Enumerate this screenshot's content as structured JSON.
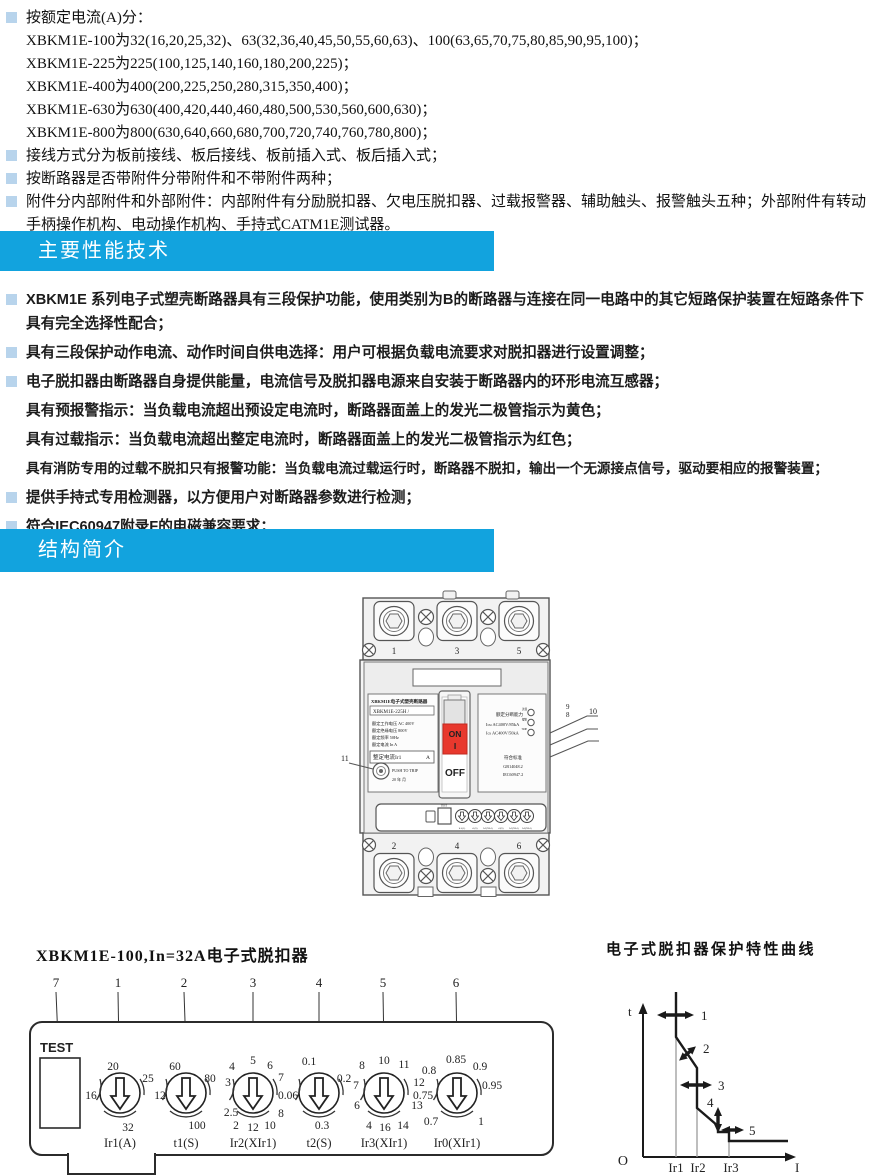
{
  "colors": {
    "accent_blue": "#12A3DE",
    "bullet_blue": "#B8D4EC",
    "on_red": "#E8382D"
  },
  "headers": {
    "performance": "主要性能技术",
    "structure": "结构简介"
  },
  "section1": {
    "items": [
      {
        "bullet": true,
        "text": "按额定电流(A)分："
      },
      {
        "bullet": false,
        "text": "XBKM1E-100为32(16,20,25,32)、63(32,36,40,45,50,55,60,63)、100(63,65,70,75,80,85,90,95,100)；"
      },
      {
        "bullet": false,
        "text": "XBKM1E-225为225(100,125,140,160,180,200,225)；"
      },
      {
        "bullet": false,
        "text": "XBKM1E-400为400(200,225,250,280,315,350,400)；"
      },
      {
        "bullet": false,
        "text": "XBKM1E-630为630(400,420,440,460,480,500,530,560,600,630)；"
      },
      {
        "bullet": false,
        "text": "XBKM1E-800为800(630,640,660,680,700,720,740,760,780,800)；"
      },
      {
        "bullet": true,
        "text": "接线方式分为板前接线、板后接线、板前插入式、板后插入式；"
      },
      {
        "bullet": true,
        "text": "按断路器是否带附件分带附件和不带附件两种；"
      },
      {
        "bullet": true,
        "text": "附件分内部附件和外部附件：内部附件有分励脱扣器、欠电压脱扣器、过载报警器、辅助触头、报警触头五种；外部附件有转动手柄操作机构、电动操作机构、手持式CATM1E测试器。"
      }
    ]
  },
  "section2": {
    "items": [
      {
        "bullet": true,
        "text": "XBKM1E 系列电子式塑壳断路器具有三段保护功能，使用类别为B的断路器与连接在同一电路中的其它短路保护装置在短路条件下具有完全选择性配合；"
      },
      {
        "bullet": true,
        "text": "具有三段保护动作电流、动作时间自供电选择：用户可根据负载电流要求对脱扣器进行设置调整；"
      },
      {
        "bullet": true,
        "text": "电子脱扣器由断路器自身提供能量，电流信号及脱扣器电源来自安装于断路器内的环形电流互感器；"
      },
      {
        "bullet": false,
        "text": "具有预报警指示：当负载电流超出预设定电流时，断路器面盖上的发光二极管指示为黄色；"
      },
      {
        "bullet": false,
        "text": "具有过载指示：当负载电流超出整定电流时，断路器面盖上的发光二极管指示为红色；"
      },
      {
        "bullet": false,
        "text": "具有消防专用的过载不脱扣只有报警功能：当负载电流过载运行时，断路器不脱扣，输出一个无源接点信号，驱动要相应的报警装置；"
      },
      {
        "bullet": true,
        "text": "提供手持式专用检测器，以方便用户对断路器参数进行检测；"
      },
      {
        "bullet": true,
        "text": "符合IEC60947附录F的电磁兼容要求；"
      }
    ]
  },
  "breaker": {
    "top_terminals": [
      "1",
      "3",
      "5"
    ],
    "bottom_terminals": [
      "2",
      "4",
      "6"
    ],
    "label": {
      "title": "XBKM1E电子式塑壳断路器",
      "model": "XBKM1E-225H /",
      "line1": "额定工作电压  AC  400V",
      "line2": "额定绝缘电压      800V",
      "line3": "额定频率          50Hz",
      "line4": "额定电流  In        A",
      "setting": "整定电流Ir1",
      "setting_unit": "A"
    },
    "switch": {
      "on": "ON",
      "on_bar": "I",
      "off": "OFF"
    },
    "right_panel": {
      "breaking": "额定分断能力",
      "icu": "Icu  AC400V/85kA",
      "ics": "Ics  AC400V/50kA",
      "led_labels": [
        "过载",
        "报警",
        "TRIP"
      ],
      "standard": "符合标准",
      "std1": "GB14048.2",
      "std2": "IEC60947.2"
    },
    "push": {
      "label": "PUSH TO TRIP",
      "date": "20  年  月"
    },
    "strip_test": "TEST",
    "strip_labels": [
      "Ir1(A)",
      "t1(S)",
      "Ir2(XIr1)",
      "t2(S)",
      "Ir3(XIr1)",
      "Ir0(XIr1)"
    ],
    "callout_left": "11",
    "callout_9": "9",
    "callout_8": "8",
    "callout_10": "10"
  },
  "trip_panel": {
    "title": "XBKM1E-100,In=32A电子式脱扣器",
    "callouts": [
      "7",
      "1",
      "2",
      "3",
      "4",
      "5",
      "6"
    ],
    "test": "TEST",
    "dials": [
      {
        "label": "Ir1(A)",
        "values": [
          "20",
          "25",
          "16",
          "32"
        ]
      },
      {
        "label": "t1(S)",
        "values": [
          "60",
          "80",
          "12",
          "100"
        ]
      },
      {
        "label": "Ir2(XIr1)",
        "values": [
          "5",
          "4",
          "6",
          "7",
          "3",
          "2.5",
          "2",
          "12",
          "10",
          "8"
        ]
      },
      {
        "label": "t2(S)",
        "values": [
          "0.1",
          "0.2",
          "0.06",
          "0.3"
        ]
      },
      {
        "label": "Ir3(XIr1)",
        "values": [
          "10",
          "8",
          "11",
          "12",
          "7",
          "13",
          "6",
          "4",
          "16",
          "14"
        ]
      },
      {
        "label": "Ir0(XIr1)",
        "values": [
          "0.85",
          "0.8",
          "0.9",
          "0.95",
          "0.75",
          "0.7",
          "1"
        ]
      }
    ]
  },
  "curve": {
    "title": "电子式脱扣器保护特性曲线",
    "t_label": "t",
    "i_label": "I",
    "origin": "O",
    "ticks": [
      "Ir1",
      "Ir2",
      "Ir3"
    ],
    "callouts": [
      "1",
      "2",
      "3",
      "4",
      "5"
    ]
  }
}
